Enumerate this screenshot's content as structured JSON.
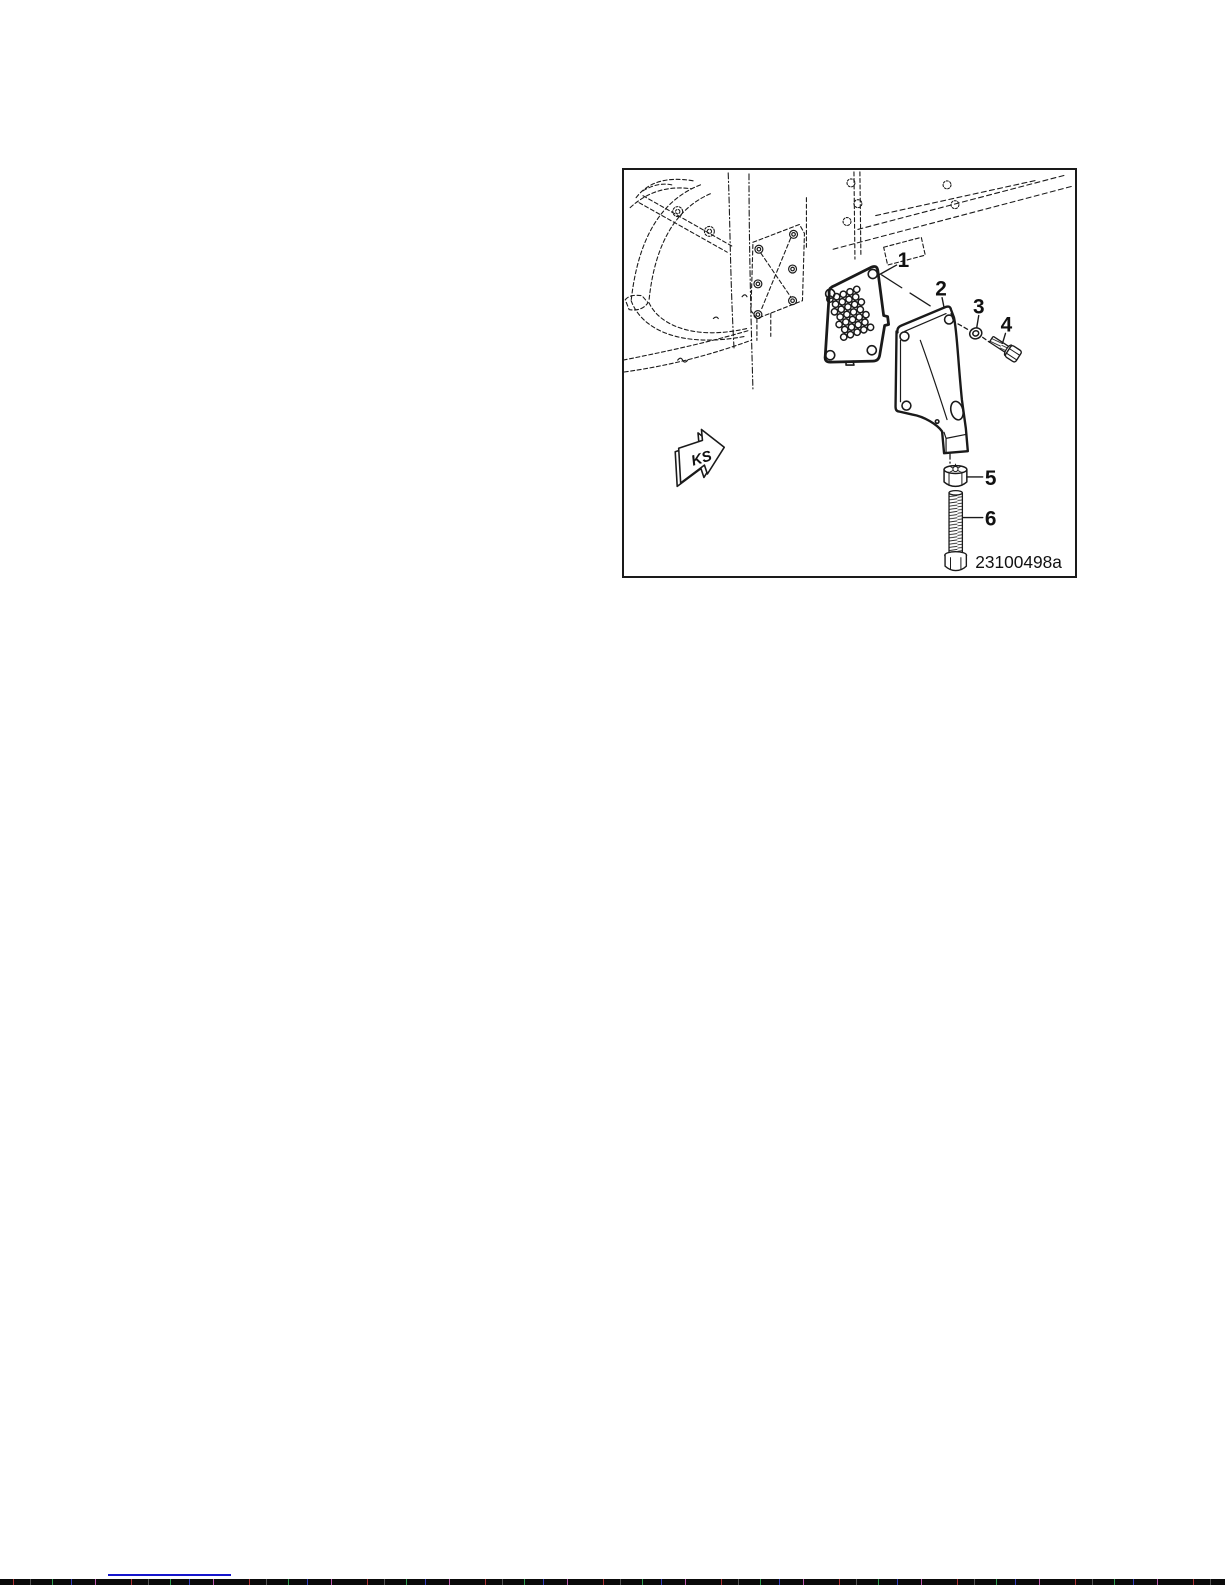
{
  "figure": {
    "image_code": "23100498a",
    "direction_label": "KS",
    "callouts": [
      "1",
      "2",
      "3",
      "4",
      "5",
      "6"
    ]
  },
  "colors": {
    "line_art": "#1a1a1a",
    "footer_rule": "#1515cc"
  }
}
